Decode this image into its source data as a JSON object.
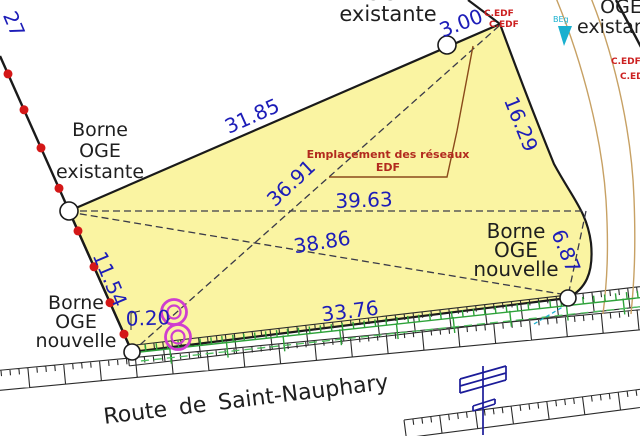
{
  "street": {
    "name": "Route de Saint-Nauphary"
  },
  "markers": {
    "borne_existante_left": {
      "line1": "Borne",
      "line2": "OGE",
      "line3": "existante"
    },
    "borne_existante_top": {
      "line1": "OGE",
      "line2": "existante"
    },
    "borne_existante_right": {
      "line1": "OGE",
      "line2": "existante"
    },
    "borne_nouvelle_left": {
      "line1": "Borne",
      "line2": "OGE",
      "line3": "nouvelle"
    },
    "borne_nouvelle_right": {
      "line1": "Borne",
      "line2": "OGE",
      "line3": "nouvelle"
    }
  },
  "annotations": {
    "edf_line1": "Emplacement des réseaux",
    "edf_line2": "EDF",
    "c_edf": "C.EDF",
    "utility_tag": "BEg"
  },
  "dimensions": {
    "top_edge": "31.85",
    "corner_offset": "3.00",
    "right_edge": "16.29",
    "diag_top": "36.91",
    "diag_mid": "39.63",
    "diag_bottom": "38.86",
    "right_short": "6.87",
    "left_edge": "11.54",
    "small_offset": "0.20",
    "bottom_edge": "33.76",
    "edge_cut": "27"
  },
  "colors": {
    "parcel_fill": "#faf4a2",
    "dimension_blue": "#1d1db8",
    "survey_point_red": "#d41717",
    "utility_magenta": "#cf3ecf",
    "road_edge_tan": "#c7a164",
    "fence_green": "#2ea23a",
    "network_cyan": "#1ab0cf",
    "edf_red": "#b22a1e"
  }
}
